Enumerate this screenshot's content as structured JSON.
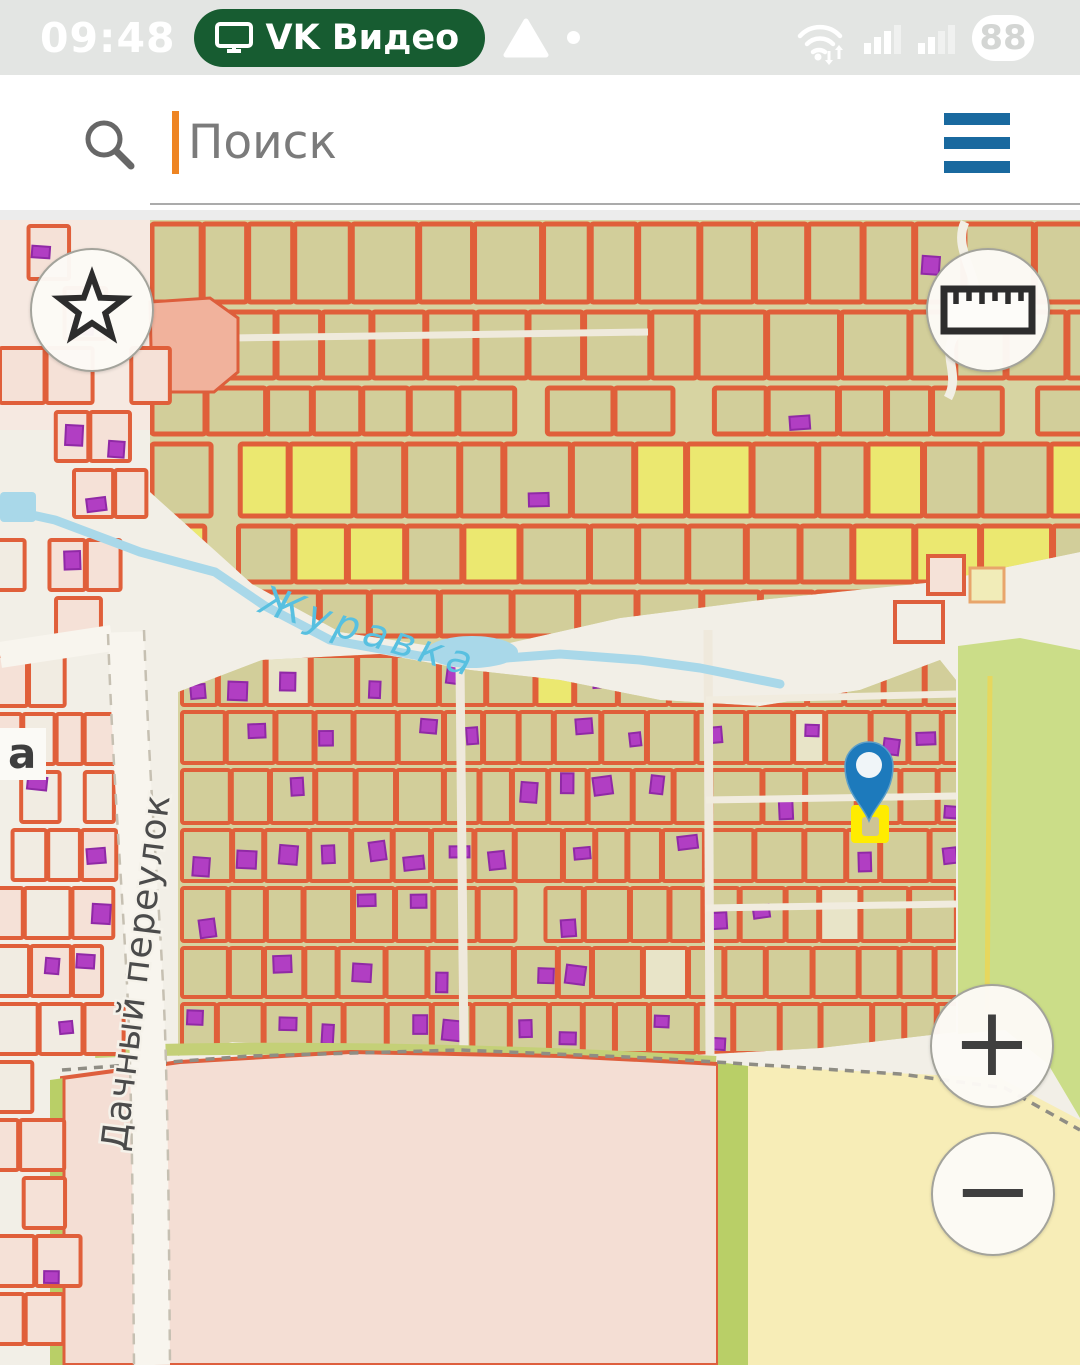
{
  "status_bar": {
    "time": "09:48",
    "cast_badge": "VK Видео",
    "battery_percent": "88"
  },
  "search": {
    "placeholder": "Поиск"
  },
  "map": {
    "labels": {
      "river": "Журавка",
      "street": "Дачный переулок",
      "partial_street": "a"
    },
    "controls": {
      "zoom_in": "+",
      "zoom_out": "−"
    },
    "colors": {
      "parcel_outline": "#e05f3a",
      "parcel_fill": "#d2ce9a",
      "parcel_fill_yellow": "#ebe870",
      "parcel_fill_cream": "#e8e4c8",
      "parcel_fill_pink": "#f5e1d7",
      "building_fill": "#b13ec3",
      "building_stroke": "#9029a6",
      "river": "#a9d8e9",
      "pin_blue": "#1d7abc",
      "selected_parcel_yellow": "#ffec00",
      "field_pink": "#f4ded4",
      "field_yellow": "#f7edb7",
      "field_green": "#cbdd88",
      "strip_green": "#b9cf67",
      "menu_blue": "#19699f",
      "cast_badge_green": "#175c31",
      "cursor_orange": "#ee8422"
    }
  }
}
